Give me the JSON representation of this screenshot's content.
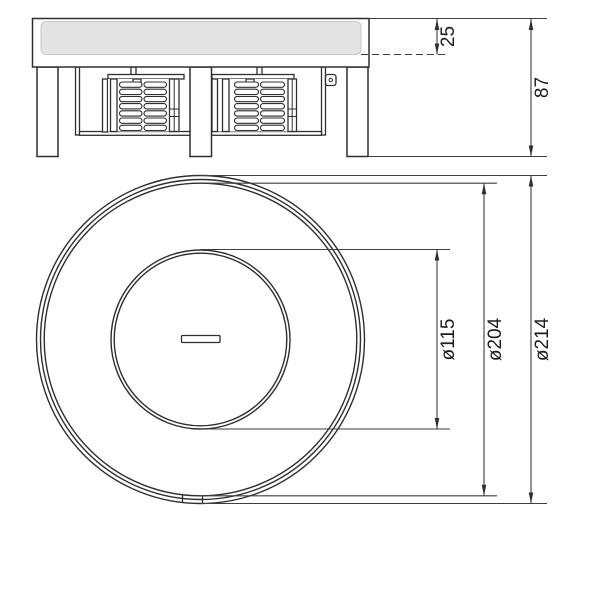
{
  "drawing": {
    "side_view": {
      "recess_depth_label": "25",
      "overall_height_label": "87"
    },
    "top_view": {
      "inner_diameter_label": "ø115",
      "cover_diameter_label": "ø204",
      "outer_diameter_label": "ø214"
    },
    "colors": {
      "line": "#2f2f2f",
      "dimension_line": "#3e3e3e",
      "cover_fill": "#e4e4e4",
      "background": "#ffffff"
    }
  }
}
